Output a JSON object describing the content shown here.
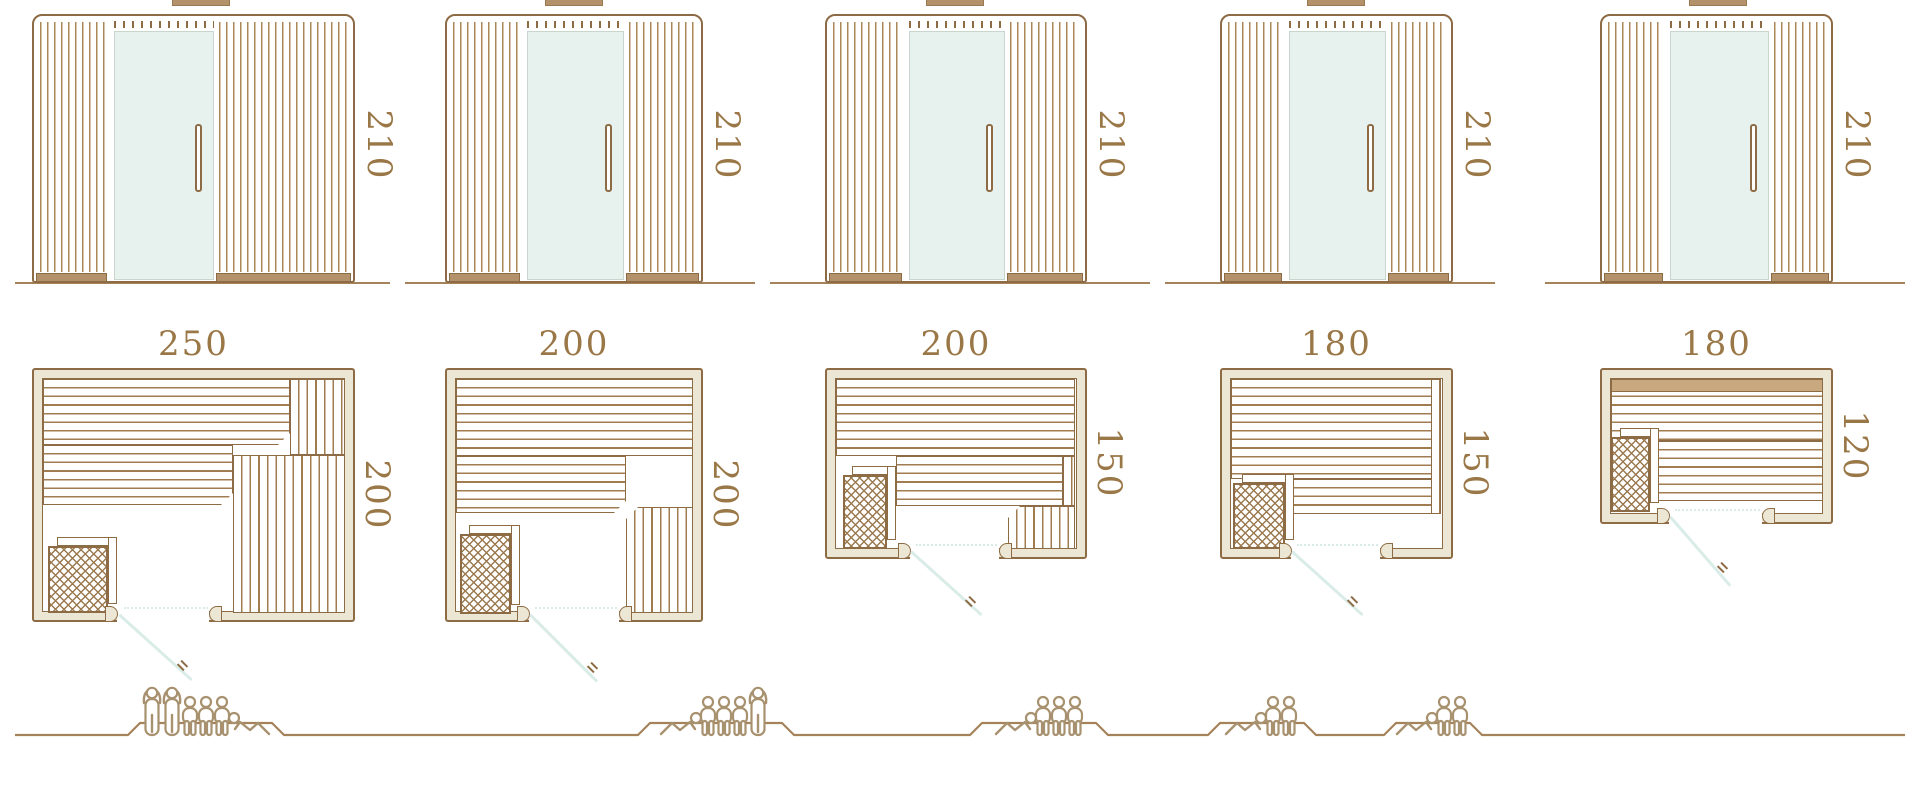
{
  "diagram": {
    "kind": "sauna size comparison sheet",
    "views": [
      "front elevation",
      "floor plan",
      "capacity figures"
    ]
  },
  "colors": {
    "line": "#8d6b44",
    "slat": "#a07c50",
    "slat2": "#ab8758",
    "label": "#9a7747",
    "wall": "#ece7d4",
    "wood": "#b3926b",
    "glass": "#e7f2ee",
    "glassb": "#c9d6cd",
    "swing": "#d9ece7",
    "fig": "#a8916f",
    "ground": "#a5825a"
  },
  "models": [
    {
      "name": "sauna-250x200",
      "elevation_height": "210",
      "plan_width": "250",
      "plan_depth": "200",
      "capacity": 6,
      "figures": [
        "standing",
        "standing",
        "sitting",
        "sitting",
        "sitting",
        "lying-flip"
      ]
    },
    {
      "name": "sauna-200x200",
      "elevation_height": "210",
      "plan_width": "200",
      "plan_depth": "200",
      "capacity": 5,
      "figures": [
        "lying",
        "sitting",
        "sitting",
        "sitting",
        "standing"
      ]
    },
    {
      "name": "sauna-200x150",
      "elevation_height": "210",
      "plan_width": "200",
      "plan_depth": "150",
      "capacity": 4,
      "figures": [
        "lying",
        "sitting",
        "sitting",
        "sitting"
      ]
    },
    {
      "name": "sauna-180x150",
      "elevation_height": "210",
      "plan_width": "180",
      "plan_depth": "150",
      "capacity": 3,
      "figures": [
        "lying",
        "sitting",
        "sitting"
      ]
    },
    {
      "name": "sauna-180x120",
      "elevation_height": "210",
      "plan_width": "180",
      "plan_depth": "120",
      "capacity": 3,
      "figures": [
        "lying",
        "sitting",
        "sitting"
      ]
    }
  ]
}
